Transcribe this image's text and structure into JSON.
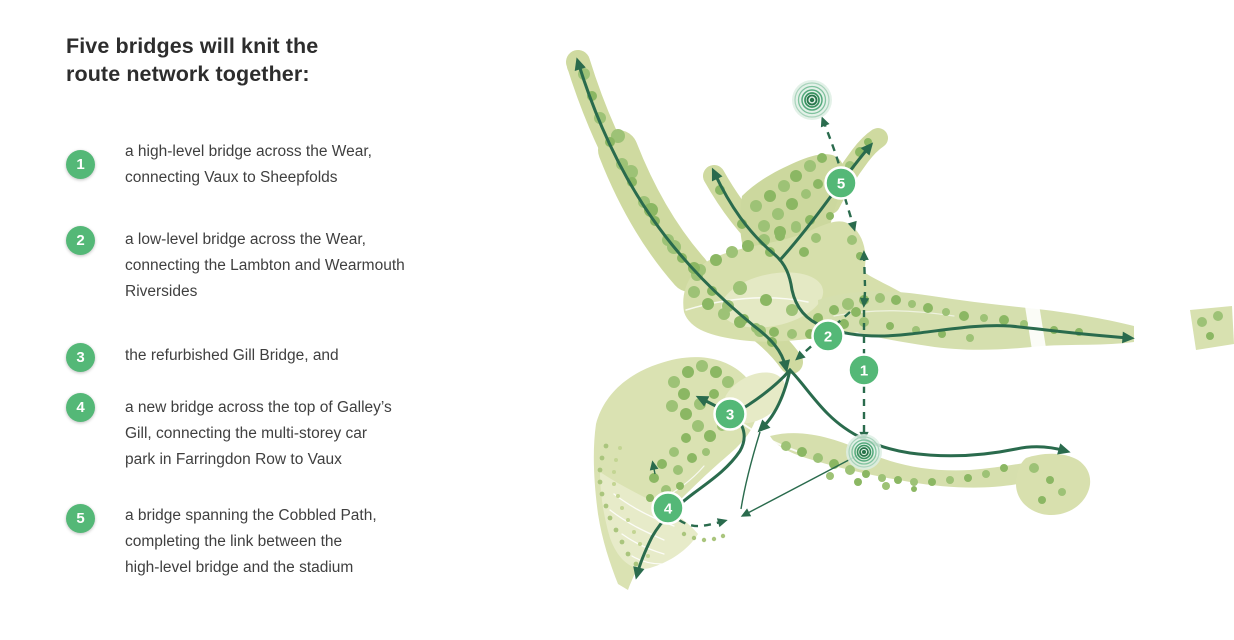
{
  "panel": {
    "heading": "Five bridges will knit the\nroute network together:",
    "items": [
      {
        "number": "1",
        "text": "a high-level bridge across the Wear,\nconnecting Vaux to Sheepfolds"
      },
      {
        "number": "2",
        "text": "a low-level bridge across the Wear,\nconnecting the Lambton and Wearmouth\nRiversides"
      },
      {
        "number": "3",
        "text": "the refurbished Gill Bridge, and"
      },
      {
        "number": "4",
        "text": "a new bridge across the top of Galley’s\nGill, connecting the multi-storey car\npark in Farringdon Row to Vaux"
      },
      {
        "number": "5",
        "text": "a bridge spanning the Cobbled Path,\ncompleting the link between the\nhigh-level bridge and the stadium"
      }
    ]
  },
  "map": {
    "markers": [
      {
        "label": "1"
      },
      {
        "label": "2"
      },
      {
        "label": "3"
      },
      {
        "label": "4"
      },
      {
        "label": "5"
      }
    ],
    "colors": {
      "marker_green": "#54b877",
      "route_green": "#2a6b4d",
      "landscape_olive": "#d3dda4",
      "tree_green": "#9dc276"
    }
  }
}
